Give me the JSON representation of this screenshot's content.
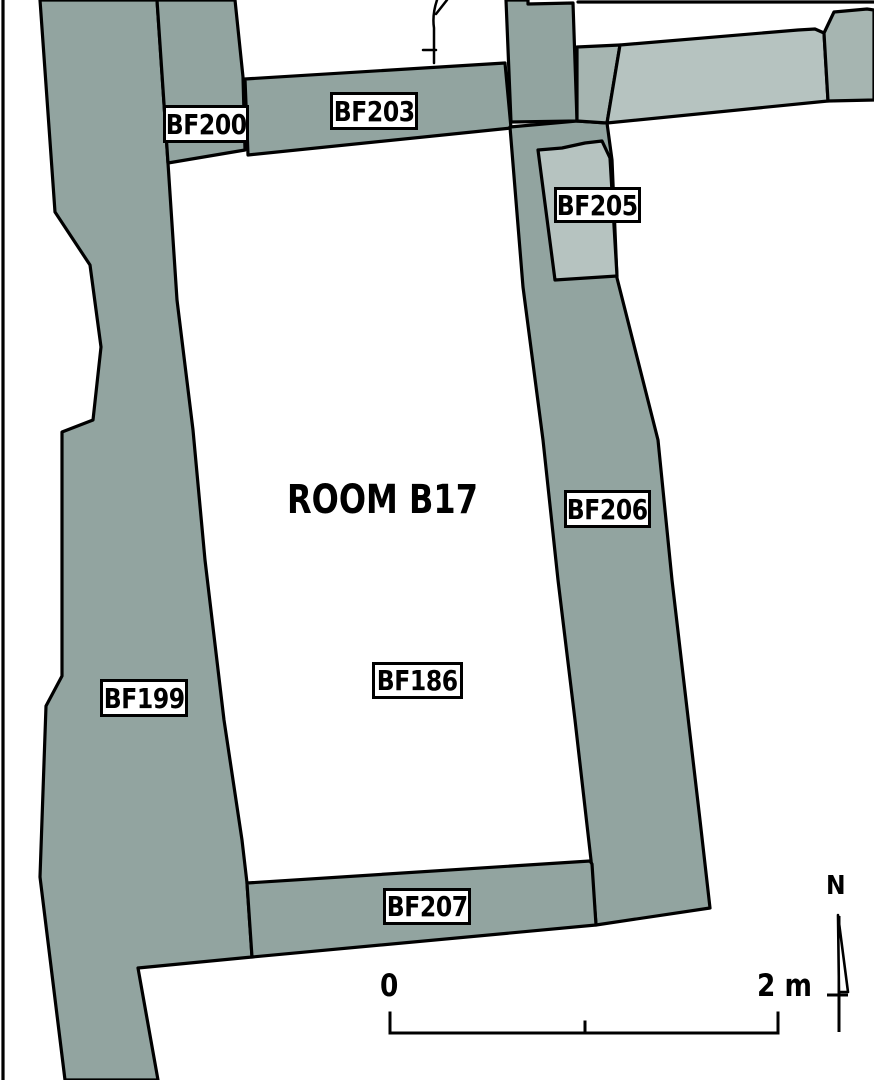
{
  "plan": {
    "room_label": "ROOM B17",
    "features": {
      "bf199": "BF199",
      "bf200": "BF200",
      "bf203": "BF203",
      "bf205": "BF205",
      "bf206": "BF206",
      "bf186": "BF186",
      "bf207": "BF207"
    },
    "scale_bar": {
      "start_label": "0",
      "end_label": "2 m"
    },
    "north_label": "N",
    "colors": {
      "wall_primary": "#92a4a0",
      "wall_light": "#b6c3c0",
      "wall_medium": "#a6b5b1",
      "line": "#000000",
      "background": "#ffffff"
    }
  }
}
